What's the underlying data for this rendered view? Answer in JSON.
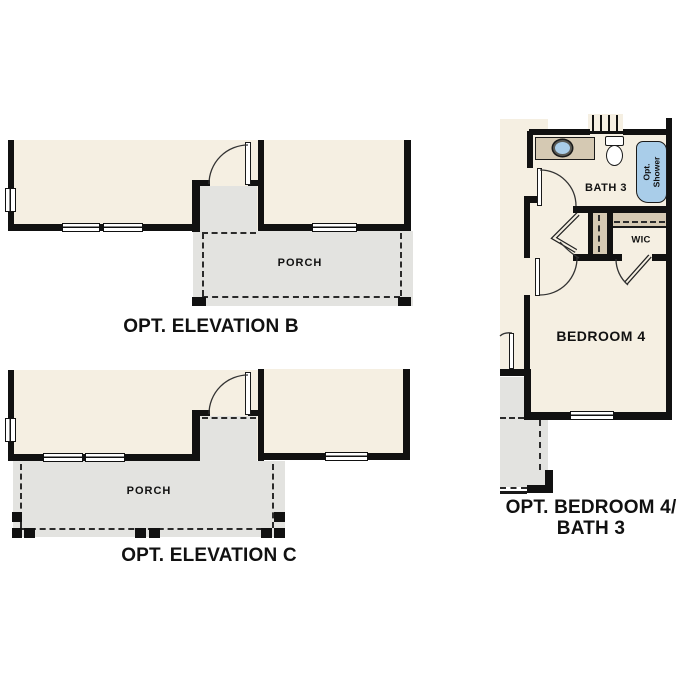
{
  "colors": {
    "interior": "#f5efe2",
    "porch": "#e3e3e0",
    "counter": "#d5c9b3",
    "fixture_blue": "#a9cde9",
    "wall": "#111111",
    "text": "#111111"
  },
  "plans": {
    "elevation_b": {
      "title": "OPT. ELEVATION B",
      "porch_label": "PORCH"
    },
    "elevation_c": {
      "title": "OPT. ELEVATION C",
      "porch_label": "PORCH"
    },
    "opt_bedroom4_bath3": {
      "title_line1": "OPT. BEDROOM 4/",
      "title_line2": "BATH 3",
      "bath_label": "BATH 3",
      "wic_label": "WIC",
      "bedroom_label": "BEDROOM 4",
      "shower_label_line1": "Opt.",
      "shower_label_line2": "Shower"
    }
  }
}
